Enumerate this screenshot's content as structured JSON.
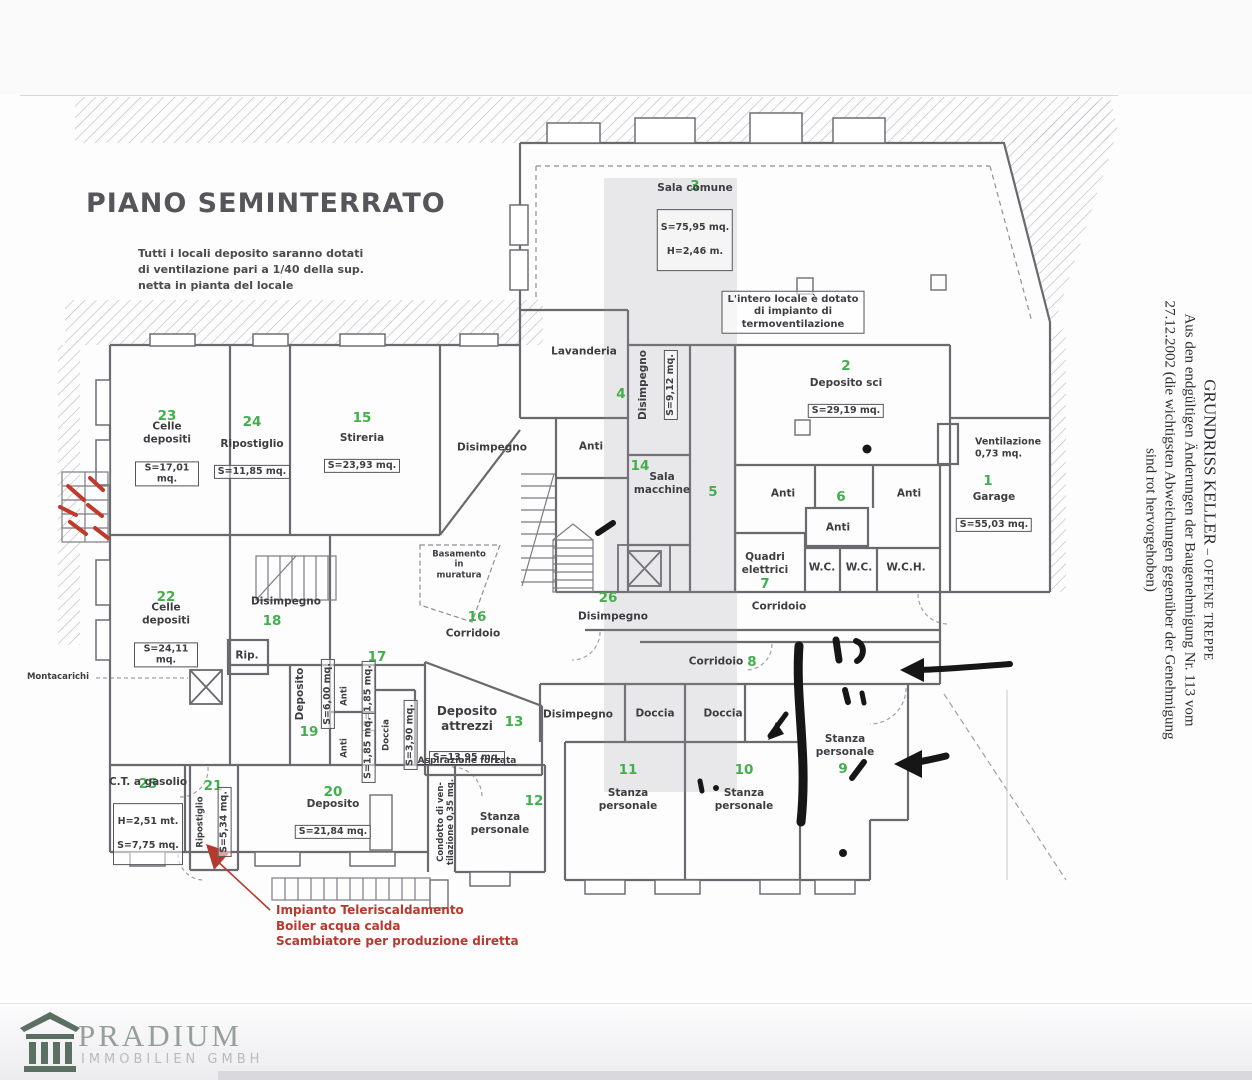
{
  "colors": {
    "green_number": "#43af4c",
    "red_annotation": "#b7392e",
    "black_marker": "#161616",
    "wall": "#69696e",
    "hatch": "#b9b9bf",
    "watermark_band": "rgba(150,150,156,0.20)",
    "brand_icon": "#5c6f63",
    "brand_text": "#96a09b"
  },
  "plan": {
    "title": "PIANO SEMINTERRATO",
    "note": "Tutti i locali deposito saranno dotati\ndi ventilazione pari a 1/40 della sup.\nnetta in pianta del locale",
    "nums": [
      {
        "n": "23"
      },
      {
        "n": "24"
      },
      {
        "n": "15"
      },
      {
        "n": "4"
      },
      {
        "n": "3"
      },
      {
        "n": "2"
      },
      {
        "n": "1"
      },
      {
        "n": "6"
      },
      {
        "n": "7"
      },
      {
        "n": "14"
      },
      {
        "n": "5"
      },
      {
        "n": "26"
      },
      {
        "n": "8"
      },
      {
        "n": "22"
      },
      {
        "n": "18"
      },
      {
        "n": "19"
      },
      {
        "n": "17"
      },
      {
        "n": "16"
      },
      {
        "n": "13"
      },
      {
        "n": "11"
      },
      {
        "n": "10"
      },
      {
        "n": "9"
      },
      {
        "n": "25"
      },
      {
        "n": "21"
      },
      {
        "n": "20"
      },
      {
        "n": "12"
      }
    ],
    "labels": [
      {
        "name": "Celle depositi",
        "area": "S=17,01 mq."
      },
      {
        "name": "Ripostiglio",
        "area": "S=11,85 mq."
      },
      {
        "name": "Stireria",
        "area": "S=23,93 mq."
      },
      {
        "name": "Disimpegno"
      },
      {
        "name": "Anti"
      },
      {
        "name": "Lavanderia"
      },
      {
        "name": "Disimpegno",
        "area": "S=9,12 mq."
      },
      {
        "name": "Sala comune",
        "area": "S=75,95 mq.",
        "extra": "H=2,46 m."
      },
      {
        "name": "L'intero locale è dotato\ndi impianto di\ntermoventilazione"
      },
      {
        "name": "Deposito sci",
        "area": "S=29,19 mq."
      },
      {
        "name": "Ventilazione\n0,73 mq."
      },
      {
        "name": "Garage",
        "area": "S=55,03 mq."
      },
      {
        "name": "Anti"
      },
      {
        "name": "Anti"
      },
      {
        "name": "Anti"
      },
      {
        "name": "Quadri elettrici"
      },
      {
        "name": "W.C."
      },
      {
        "name": "W.C."
      },
      {
        "name": "W.C.H."
      },
      {
        "name": "Sala macchine"
      },
      {
        "name": "Disimpegno"
      },
      {
        "name": "Corridoio"
      },
      {
        "name": "Corridoio"
      },
      {
        "name": "Celle depositi",
        "area": "S=24,11 mq."
      },
      {
        "name": "Disimpegno"
      },
      {
        "name": "Rip."
      },
      {
        "name": "Deposito",
        "area": "S=6,00 mq."
      },
      {
        "name": "Anti",
        "area": "S=1,85 mq."
      },
      {
        "name": "Anti",
        "area": "S=1,85 mq."
      },
      {
        "name": "Doccia",
        "area": "S=3,90 mq."
      },
      {
        "name": "Corridoio"
      },
      {
        "name": "Deposito attrezzi",
        "area": "S=13,95 mq."
      },
      {
        "name": "Aspirazione forzata"
      },
      {
        "name": "Disimpegno"
      },
      {
        "name": "Doccia"
      },
      {
        "name": "Doccia"
      },
      {
        "name": "Stanza personale"
      },
      {
        "name": "Stanza personale"
      },
      {
        "name": "Stanza personale"
      },
      {
        "name": "C.T. a gasolio",
        "extra": "H=2,51 mt.",
        "area": "S=7,75 mq."
      },
      {
        "name": "Ripostiglio",
        "area": "S=5,34 mq."
      },
      {
        "name": "Deposito",
        "area": "S=21,84 mq."
      },
      {
        "name": "Stanza personale"
      },
      {
        "name": "Condotto di ven-\ntilazione 0,35 mq."
      },
      {
        "name": "Basamento\nin\nmuratura"
      },
      {
        "name": "Montacarichi"
      }
    ]
  },
  "annotations": {
    "red_note": "Impianto Teleriscaldamento\nBoiler acqua calda\nScambiatore per produzione diretta"
  },
  "side_text": {
    "title": "GRUNDRISS KELLER",
    "title_suffix": " – OFFENE TREPPE",
    "line2": "Aus den endgültigen Änderungen der Baugenehmigung Nr. 113 vom",
    "line3": "27.12.2002 (die wichtigsten Abweichungen gegenüber der Genehmigung",
    "line4": "sind rot hervorgehoben)"
  },
  "footer": {
    "brand": "PRADIUM",
    "subtitle": "IMMOBILIEN GMBH"
  }
}
